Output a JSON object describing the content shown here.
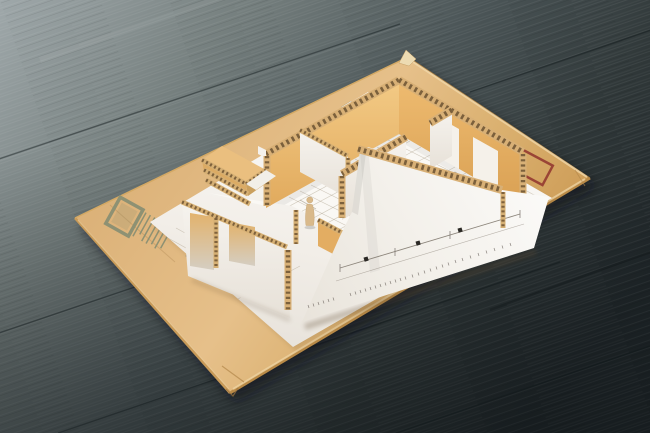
{
  "scene": {
    "description": "Photograph of a cardboard architectural scale model of an apartment, with corrugated cardboard walls and a tiny human figurine, standing on a printed floor-plan sheet glued over a kraft cardboard board, lying on a dark blue-grey wooden table",
    "objects": [
      "wood-table-surface",
      "kraft-cardboard-board",
      "floor-plan-paper-sheet",
      "cardboard-house-model",
      "corrugated-wall-edges",
      "miniature-human-figure",
      "olive-barcode-stamp",
      "red-rectangle-stamp",
      "front-elevation-paper-apron"
    ],
    "palette": {
      "wood_light": "#9fa8aa",
      "wood_dark": "#20272a",
      "cardboard": "#dcb279",
      "cardboard_edge": "#b98a47",
      "paper_white": "#f7f5f1",
      "wall_tan_light": "#f3ca85",
      "wall_tan_dark": "#d9a053",
      "corrugation_dark": "#6b5233",
      "white_wall": "#f4f1eb",
      "figure_tan": "#d9b98a",
      "stamp_olive": "#8e9173",
      "stamp_red": "#943a31",
      "plan_line_grey": "#a99d88"
    }
  }
}
